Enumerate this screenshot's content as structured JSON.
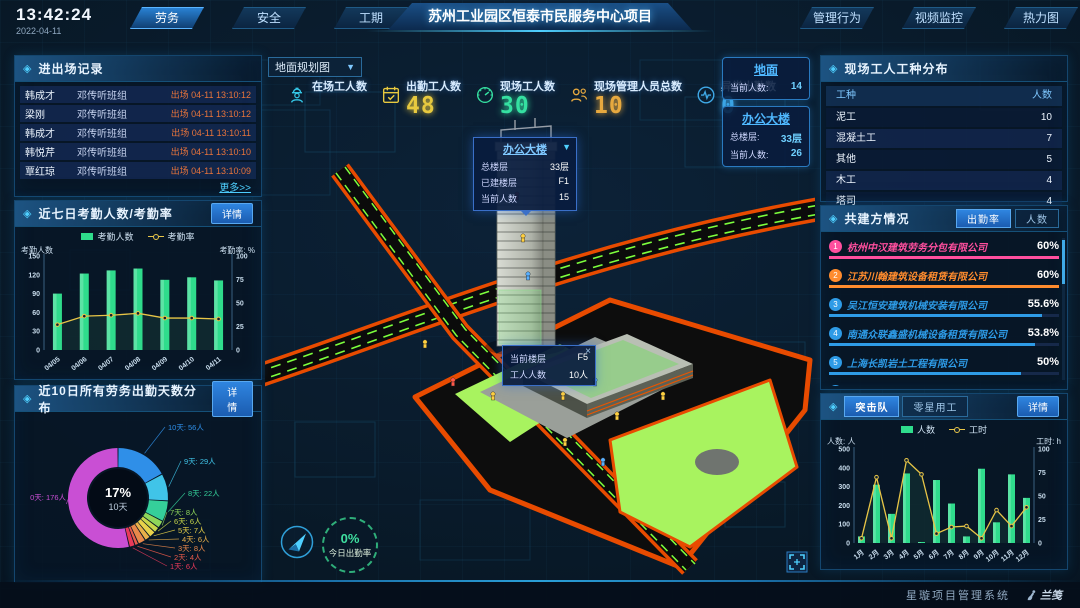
{
  "header": {
    "time": "13:42:24",
    "date": "2022-04-11",
    "nav_left": [
      {
        "label": "劳务",
        "active": true
      },
      {
        "label": "安全",
        "active": false
      },
      {
        "label": "工期",
        "active": false
      }
    ],
    "title": "苏州工业园区恒泰市民服务中心项目",
    "nav_right": [
      {
        "label": "管理行为",
        "active": false
      },
      {
        "label": "视频监控",
        "active": false
      },
      {
        "label": "热力图",
        "active": false
      }
    ]
  },
  "panels": {
    "entry_exit": {
      "title": "进出场记录",
      "more": "更多>>",
      "rows": [
        {
          "name": "韩成才",
          "team": "邓传听班组",
          "event": "出场 04-11 13:10:12"
        },
        {
          "name": "梁刚",
          "team": "邓传听班组",
          "event": "出场 04-11 13:10:12"
        },
        {
          "name": "韩成才",
          "team": "邓传听班组",
          "event": "出场 04-11 13:10:11"
        },
        {
          "name": "韩悦芹",
          "team": "邓传听班组",
          "event": "出场 04-11 13:10:10"
        },
        {
          "name": "覃红琼",
          "team": "邓传听班组",
          "event": "出场 04-11 13:10:09"
        }
      ]
    },
    "attendance": {
      "title": "近七日考勤人数/考勤率",
      "detail": "详情"
    },
    "distribution": {
      "title": "近10日所有劳务出勤天数分布",
      "detail": "详情"
    },
    "worker_types": {
      "title": "现场工人工种分布",
      "columns": [
        "工种",
        "人数"
      ],
      "rows": [
        [
          "泥工",
          "10"
        ],
        [
          "混凝土工",
          "7"
        ],
        [
          "其他",
          "5"
        ],
        [
          "木工",
          "4"
        ],
        [
          "塔司",
          "4"
        ]
      ]
    },
    "partners": {
      "title": "共建方情况",
      "tabs": [
        {
          "label": "出勤率",
          "active": true
        },
        {
          "label": "人数",
          "active": false
        }
      ],
      "rows": [
        {
          "rank": "1",
          "name": "杭州中汉建筑劳务分包有限公司",
          "value": "60%",
          "rate": 60,
          "color": "#ff4f9e"
        },
        {
          "rank": "2",
          "name": "江苏川翰建筑设备租赁有限公司",
          "value": "60%",
          "rate": 60,
          "color": "#ff8c2e"
        },
        {
          "rank": "3",
          "name": "吴江恒安建筑机械安装有限公司",
          "value": "55.6%",
          "rate": 55.6,
          "color": "#2e9be6"
        },
        {
          "rank": "4",
          "name": "南通众联鑫盛机械设备租赁有限公司",
          "value": "53.8%",
          "rate": 53.8,
          "color": "#2e9be6"
        },
        {
          "rank": "5",
          "name": "上海长凯岩土工程有限公司",
          "value": "50%",
          "rate": 50,
          "color": "#2e9be6"
        },
        {
          "rank": "6",
          "name": "江苏法治建筑安装工程有限公司",
          "value": "35.4%",
          "rate": 35.4,
          "color": "#2e9be6"
        }
      ]
    },
    "assault": {
      "tabs": [
        {
          "label": "突击队",
          "active": true
        },
        {
          "label": "零星用工",
          "active": false
        }
      ],
      "detail": "详情"
    }
  },
  "map": {
    "layer_select": "地面规划图",
    "stats": [
      {
        "label": "在场工人数",
        "value": "",
        "icon": "worker-icon",
        "color": "#35c8e8"
      },
      {
        "label": "出勤工人数",
        "value": "48",
        "icon": "calendar-icon",
        "color": "#e7c93f"
      },
      {
        "label": "现场工人数",
        "value": "30",
        "icon": "gauge-icon",
        "color": "#35e0a1"
      },
      {
        "label": "现场管理人员总数",
        "value": "10",
        "icon": "people-icon",
        "color": "#e7a93f"
      },
      {
        "label": "异常出勤数",
        "value": "0",
        "icon": "pulse-icon",
        "color": "#3fa9e7"
      }
    ],
    "building_tooltip": {
      "title": "办公大楼",
      "rows": [
        [
          "总楼层",
          "33层"
        ],
        [
          "已建楼层",
          "F1"
        ],
        [
          "当前人数",
          "15"
        ]
      ]
    },
    "floor_tooltip": {
      "rows": [
        [
          "当前楼层",
          "F5"
        ],
        [
          "工人人数",
          "10人"
        ]
      ],
      "close": "×"
    },
    "ground_card": {
      "title": "地面",
      "rows": [
        [
          "当前人数:",
          "14"
        ]
      ]
    },
    "office_card": {
      "title": "办公大楼",
      "rows": [
        [
          "总楼层:",
          "33层"
        ],
        [
          "当前人数:",
          "26"
        ]
      ]
    },
    "gauge": {
      "value": "0%",
      "label": "今日出勤率"
    }
  },
  "footer": {
    "system": "星璇项目管理系统",
    "brand": "兰笺"
  },
  "chart_data": [
    {
      "id": "attendance",
      "type": "bar+line",
      "title": "近七日考勤人数/考勤率",
      "categories": [
        "04/05",
        "04/06",
        "04/07",
        "04/08",
        "04/09",
        "04/10",
        "04/11"
      ],
      "series": [
        {
          "name": "考勤人数",
          "type": "bar",
          "color": "#2fdc8c",
          "axis": "left",
          "values": [
            90,
            122,
            127,
            130,
            112,
            116,
            111
          ]
        },
        {
          "name": "考勤率",
          "type": "line",
          "color": "#e8c547",
          "axis": "right",
          "values": [
            27,
            36,
            37,
            39,
            34,
            34,
            33
          ]
        }
      ],
      "left_axis": {
        "label": "考勤人数",
        "min": 0,
        "max": 150,
        "ticks": [
          0,
          30,
          60,
          90,
          120,
          150
        ]
      },
      "right_axis": {
        "label": "考勤率: %",
        "min": 0,
        "max": 100,
        "ticks": [
          0,
          25,
          50,
          75,
          100
        ]
      },
      "legend_position": "top",
      "grid": false
    },
    {
      "id": "distribution",
      "type": "donut",
      "title": "近10日所有劳务出勤天数分布",
      "center": {
        "pct": "17%",
        "label": "10天"
      },
      "slices": [
        {
          "label": "10天",
          "count": "56人",
          "value": 56,
          "color": "#2f8fe8"
        },
        {
          "label": "9天",
          "count": "29人",
          "value": 29,
          "color": "#40c4e8"
        },
        {
          "label": "8天",
          "count": "22人",
          "value": 22,
          "color": "#35cf9a"
        },
        {
          "label": "7天",
          "count": "8人",
          "value": 8,
          "color": "#8fd65a"
        },
        {
          "label": "6天",
          "count": "6人",
          "value": 6,
          "color": "#c8d64a"
        },
        {
          "label": "5天",
          "count": "7人",
          "value": 7,
          "color": "#e8d24a"
        },
        {
          "label": "4天",
          "count": "6人",
          "value": 6,
          "color": "#e8b04a"
        },
        {
          "label": "3天",
          "count": "8人",
          "value": 8,
          "color": "#e8884a"
        },
        {
          "label": "2天",
          "count": "4人",
          "value": 4,
          "color": "#e85a4a"
        },
        {
          "label": "1天",
          "count": "6人",
          "value": 6,
          "color": "#e83a5a"
        },
        {
          "label": "0天",
          "count": "176人",
          "value": 176,
          "color": "#c94fd4"
        }
      ]
    },
    {
      "id": "assault",
      "type": "bar+line",
      "title": "突击队",
      "categories": [
        "1月",
        "2月",
        "3月",
        "4月",
        "5月",
        "6月",
        "7月",
        "8月",
        "9月",
        "10月",
        "11月",
        "12月"
      ],
      "series": [
        {
          "name": "人数",
          "type": "bar",
          "color": "#2fdc8c",
          "axis": "left",
          "values": [
            35,
            310,
            155,
            370,
            5,
            335,
            210,
            35,
            395,
            110,
            365,
            240
          ]
        },
        {
          "name": "工时",
          "type": "line",
          "color": "#e8c547",
          "axis": "right",
          "values": [
            5,
            70,
            5,
            88,
            73,
            10,
            17,
            18,
            5,
            35,
            18,
            38
          ]
        }
      ],
      "left_axis": {
        "label": "人数: 人",
        "min": 0,
        "max": 500,
        "ticks": [
          0,
          100,
          200,
          300,
          400,
          500
        ]
      },
      "right_axis": {
        "label": "工时: h",
        "min": 0,
        "max": 100,
        "ticks": [
          0,
          25,
          50,
          75,
          100
        ]
      },
      "legend_position": "top",
      "grid": false
    }
  ]
}
